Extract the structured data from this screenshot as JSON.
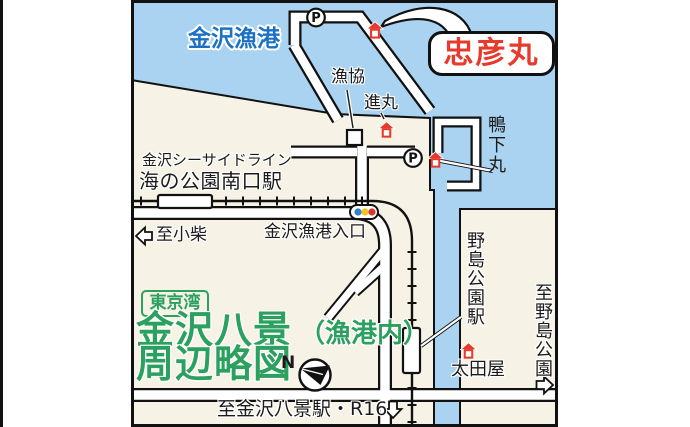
{
  "colors": {
    "water": "#A9D3F0",
    "land": "#F6F3E6",
    "ink": "#1B1B1B",
    "road": "#FFFFFF",
    "green": "#2BA05F",
    "red": "#E8392D",
    "blue_label": "#1C71C5",
    "signal_blue": "#3180C8",
    "signal_yellow": "#EFC421",
    "signal_red": "#D3392E"
  },
  "map": {
    "water_label": "金沢漁港",
    "callout_label": "忠彦丸",
    "parking": "P",
    "pois": {
      "fishing_coop": "漁協",
      "shinmaru": "進丸",
      "kamoshitamaru": "鴨下丸",
      "otaya": "太田屋"
    },
    "transit": {
      "line_name": "金沢シーサイドライン",
      "south_gate_station": "海の公園南口駅",
      "nojima_park_station": "野島公園駅"
    },
    "directions": {
      "to_koshiba": "至小柴",
      "to_nojima_park": "至野島公園",
      "to_hakkei_station": "至金沢八景駅・R16"
    },
    "intersection": "金沢漁港入口",
    "title": {
      "bay_badge": "東京湾",
      "line1_main": "金沢八景",
      "line1_paren": "（漁港内）",
      "line2": "周辺略図"
    },
    "compass_north": "N"
  }
}
